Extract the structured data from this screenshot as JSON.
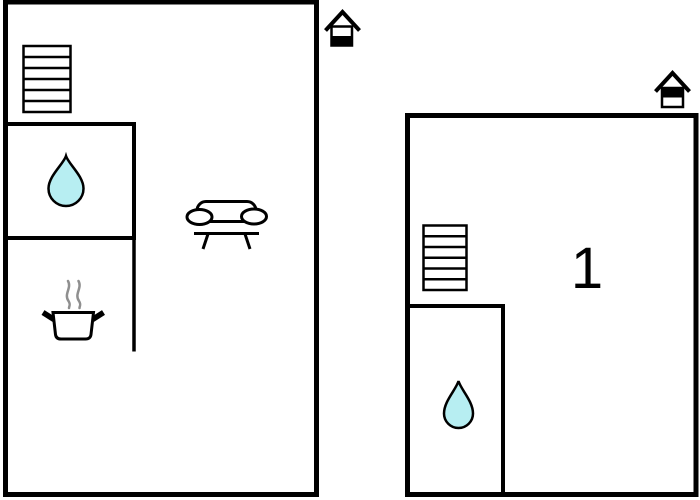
{
  "diagram": {
    "type": "floor-plan",
    "description": "Two-level property floor plan with furnishing icons"
  },
  "colors": {
    "wall": "#000000",
    "water_drop_fill": "#b7eef2",
    "water_drop_stroke": "#000000",
    "steam": "#8f8f8f",
    "background": "#ffffff"
  },
  "floors": [
    {
      "id": "ground-floor",
      "label": "",
      "level_marker_icon": "house-icon-bottom-half-filled",
      "icons": [
        "staircase-icon",
        "water-drop-icon",
        "cooking-pot-icon",
        "sofa-icon"
      ]
    },
    {
      "id": "first-floor",
      "label": "1",
      "level_marker_icon": "house-icon-top-half-filled",
      "icons": [
        "staircase-icon",
        "water-drop-icon"
      ]
    }
  ]
}
